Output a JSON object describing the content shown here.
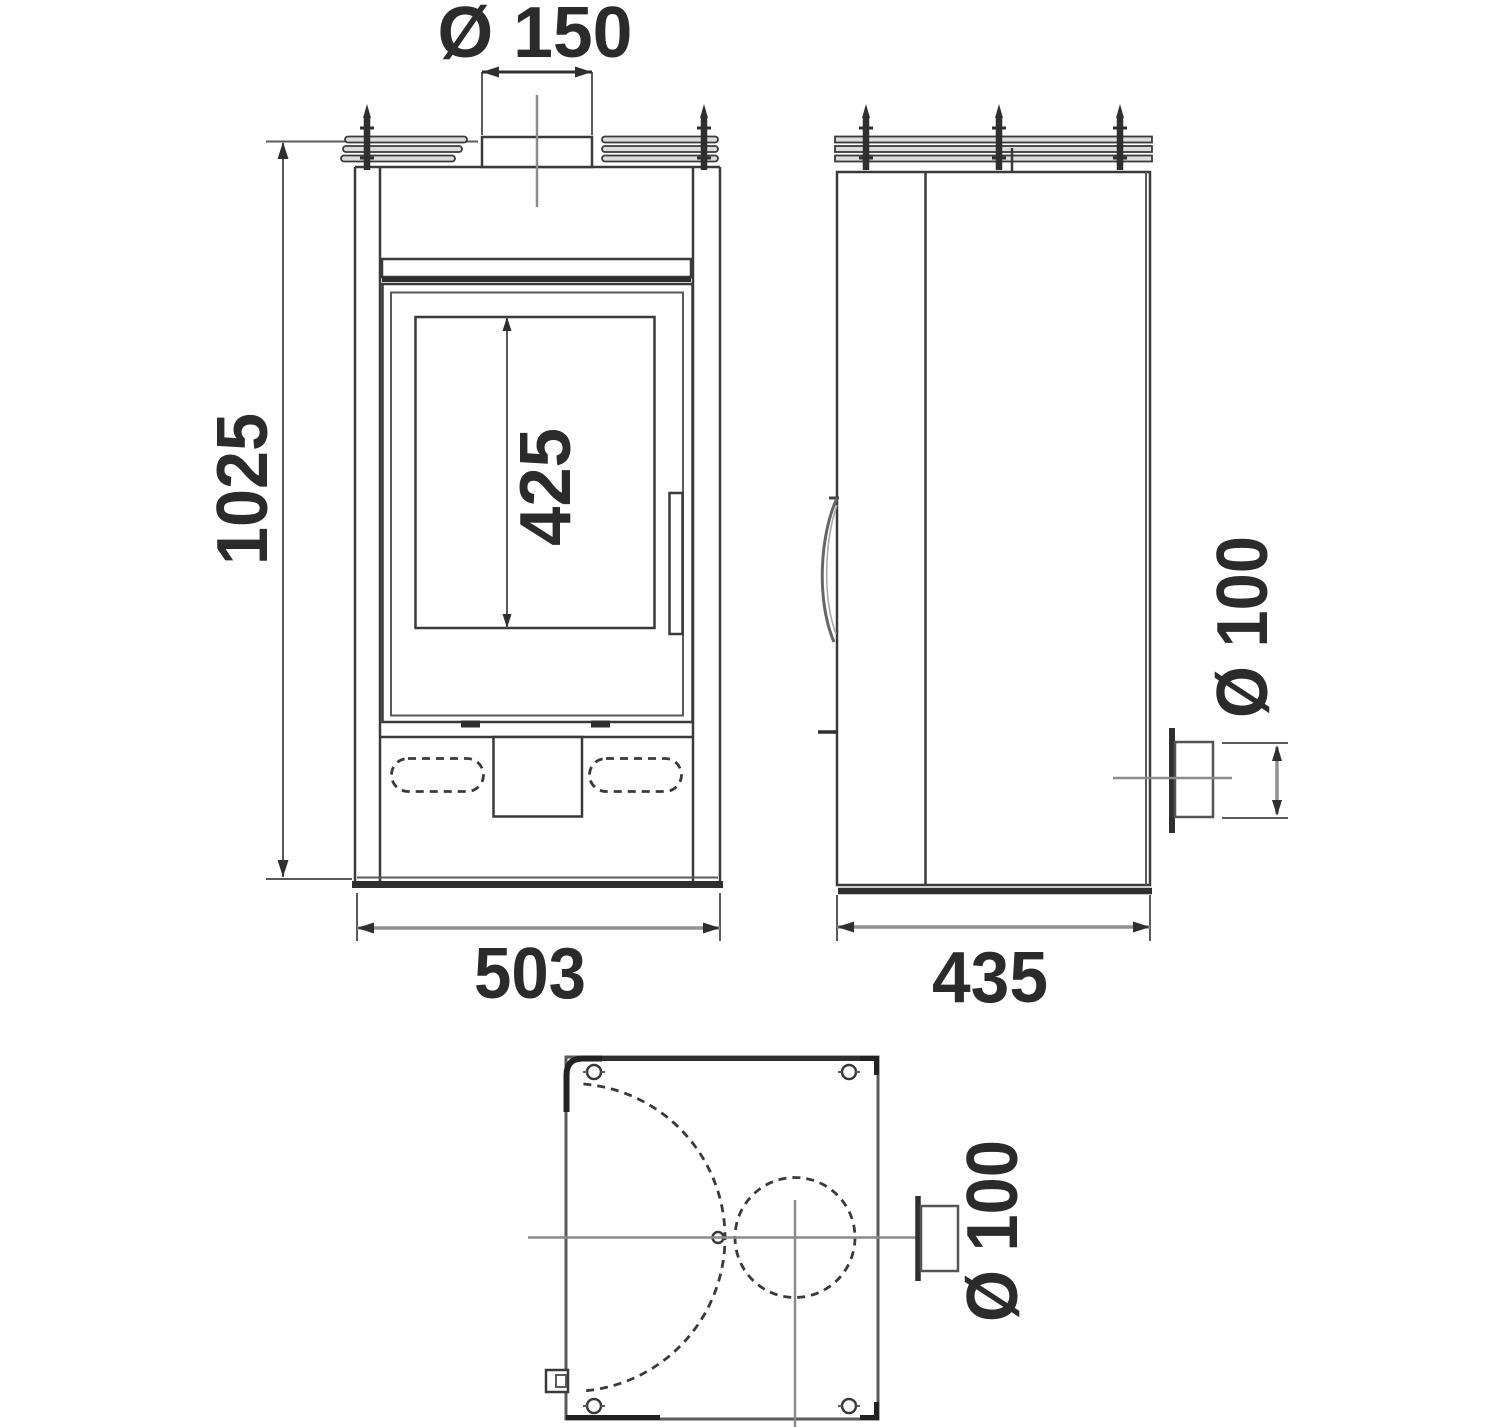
{
  "drawing": {
    "colors": {
      "background": "#ffffff",
      "line": "#3a3a3a",
      "heavy_line": "#2f2f2f",
      "centerline": "#8c8c8c",
      "dimension_line": "#909090",
      "text": "#2b2b2b"
    },
    "dimensions": {
      "flue_collar_diameter": {
        "label": "Ø 150"
      },
      "overall_height": {
        "label": "1025"
      },
      "glass_height": {
        "label": "425"
      },
      "overall_width": {
        "label": "503"
      },
      "overall_depth": {
        "label": "435"
      },
      "rear_outlet_diameter_side": {
        "label": "Ø 100"
      },
      "rear_outlet_diameter_plan": {
        "label": "Ø 100"
      }
    }
  }
}
